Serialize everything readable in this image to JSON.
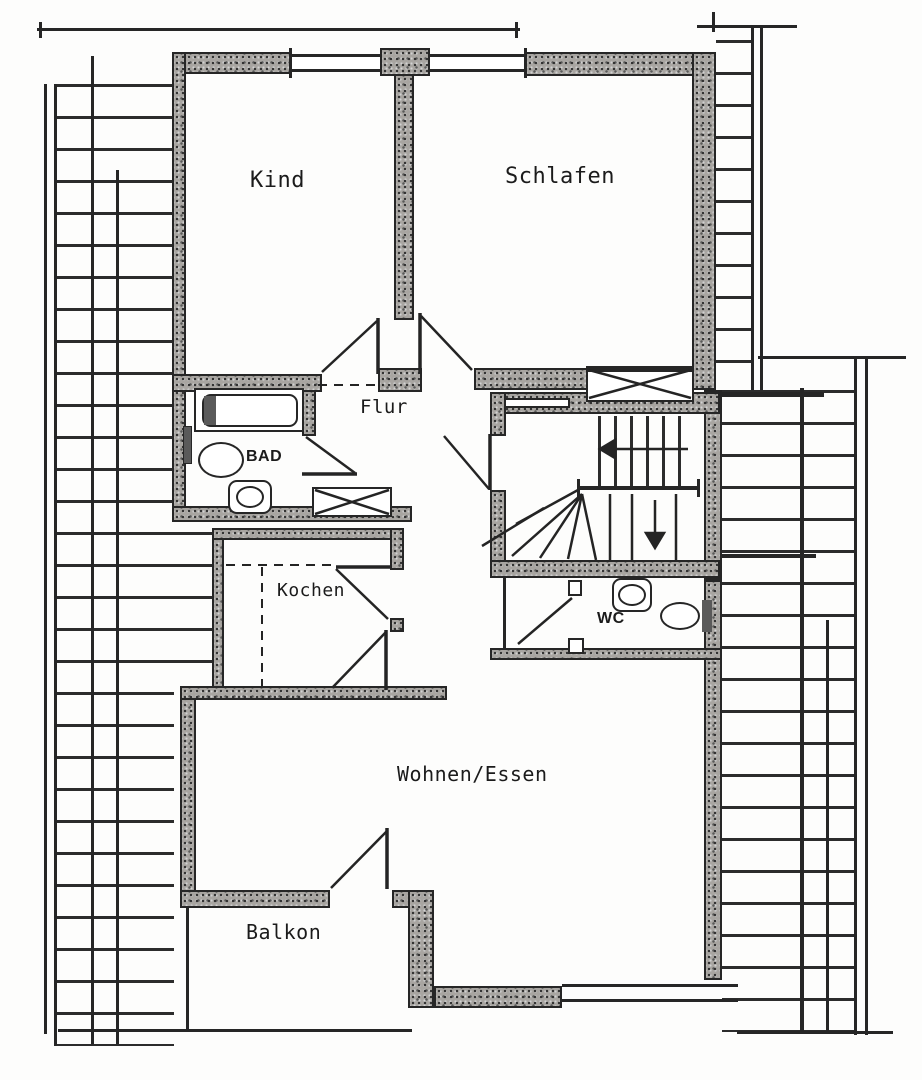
{
  "rooms": {
    "kind": "Kind",
    "schlafen": "Schlafen",
    "flur": "Flur",
    "bad": "BAD",
    "kochen": "Kochen",
    "wc": "WC",
    "wohnen_essen": "Wohnen/Essen",
    "balkon": "Balkon"
  },
  "colors": {
    "ink": "#262626",
    "wall_fill": "#a8a5a1",
    "paper": "#fdfdfc"
  }
}
